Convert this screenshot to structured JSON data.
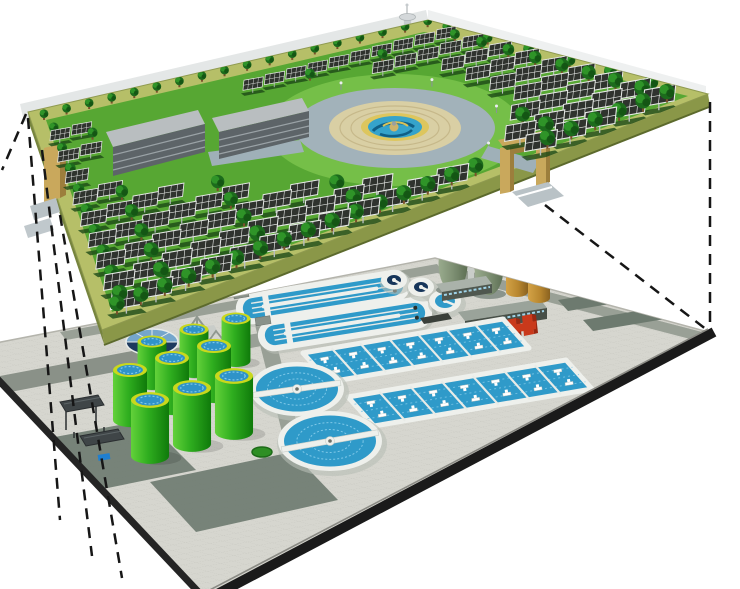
{
  "meta": {
    "type": "3d-concept-illustration",
    "subject": "Rooftop solar park and garden deck built above a wastewater treatment plant, shown as an exploded view with dashed projection lines"
  },
  "colors": {
    "background": "#ffffff",
    "deck_grass": "#57a733",
    "deck_lawn_light": "#79c24a",
    "deck_border_path": "#b6bf68",
    "deck_side": "#8a9748",
    "deck_side_left": "#76843d",
    "deck_side_dark": "#5c6a2c",
    "grass_row_shadow": "#1d4a16",
    "tree_dark": "#1c6b1c",
    "tree_mid": "#2f9428",
    "tree_deep": "#145414",
    "tree_trunk": "#7a512b",
    "panel_dark": "#2f332e",
    "panel_frame": "#e6e9e6",
    "panel_post": "#b9bec0",
    "back_wall": "#e4e7e7",
    "back_wall_right": "#eef0f0",
    "tower_grey": "#c6cbce",
    "building_roof": "#b9bec0",
    "building_face": "#5d6468",
    "building_stripe": "#9aa2a6",
    "plaza_ring": "#a2b2ba",
    "plaza_inner": "#d9cfa4",
    "plaza_ring_line": "#c6b88a",
    "fountain_rim": "#ddc65e",
    "fountain_water": "#35a3cb",
    "fountain_swirl": "#0f5f86",
    "fountain_center": "#cdb36a",
    "gate_tan": "#c9a85c",
    "gate_tan_dark": "#9c7e3c",
    "ramp_grey": "#b9c2c6",
    "platform_paving": "#d6d6cf",
    "paving_line": "#c6c6bf",
    "road_grey": "#99a096",
    "road_dark": "#6d7a6f",
    "road_left": "#8a9188",
    "platform_edge": "#1a1a1a",
    "platform_edge_hi": "#8a8a84",
    "white_concrete": "#eef0ec",
    "concrete_shadow": "#c9cfc9",
    "water_blue": "#2f9ac9",
    "water_deep": "#16355a",
    "water_light": "#7fc8e8",
    "lane_divider": "#e8ebe7",
    "tank_green_light": "#63d13a",
    "tank_green": "#2fae1f",
    "tank_green_dark": "#0f7a0a",
    "tank_rim": "#c9d81d",
    "egg_green": "#7e9073",
    "egg_green_light": "#9aab8e",
    "egg_green_dark": "#5d6f54",
    "egg_cap": "#3c4a39",
    "steel_grey": "#c9cdc9",
    "dark_building": "#474f47",
    "building_lower_roof": "#9aa39a",
    "window_strip": "#9fd3e8",
    "brown_tank": "#b8872f",
    "brown_tank_dark": "#7d5a1d",
    "red_equipment": "#c9391b",
    "red_equipment_dark": "#9a2812",
    "gas_holder_navy": "#1d3a5e",
    "gas_holder_light": "#7fb2d8",
    "shed_dark": "#3f4547",
    "accent_blue_dot": "#1f7fd0",
    "dash_line": "#161616"
  },
  "upper_level": {
    "label": "rooftop-solar-park",
    "components": [
      "solar-panel-arrays",
      "tree-rows",
      "central-fountain-plaza",
      "observation-tower",
      "service-buildings",
      "entrance-gates",
      "perimeter-path"
    ]
  },
  "lower_level": {
    "label": "wastewater-treatment-plant",
    "components": [
      "secondary-clarifiers",
      "small-clarifiers",
      "oxidation-ditches",
      "aeration-basins",
      "sludge-digester-tanks",
      "egg-shaped-digesters",
      "storage-tanks",
      "gas-holder",
      "pump-buildings",
      "red-pump-equipment",
      "equipment-sheds",
      "service-roads"
    ]
  },
  "counts": {
    "large_clarifiers": 2,
    "small_clarifiers": 3,
    "oxidation_ditches": 2,
    "aeration_basins": 2,
    "sludge_digester_tanks": 9,
    "egg_digesters": 2,
    "storage_tanks": 2,
    "service_buildings_upper": 2,
    "entrance_gates": 2,
    "solar_panel_rows": 9,
    "projection_lines_left": 4,
    "projection_lines_right": 2
  }
}
